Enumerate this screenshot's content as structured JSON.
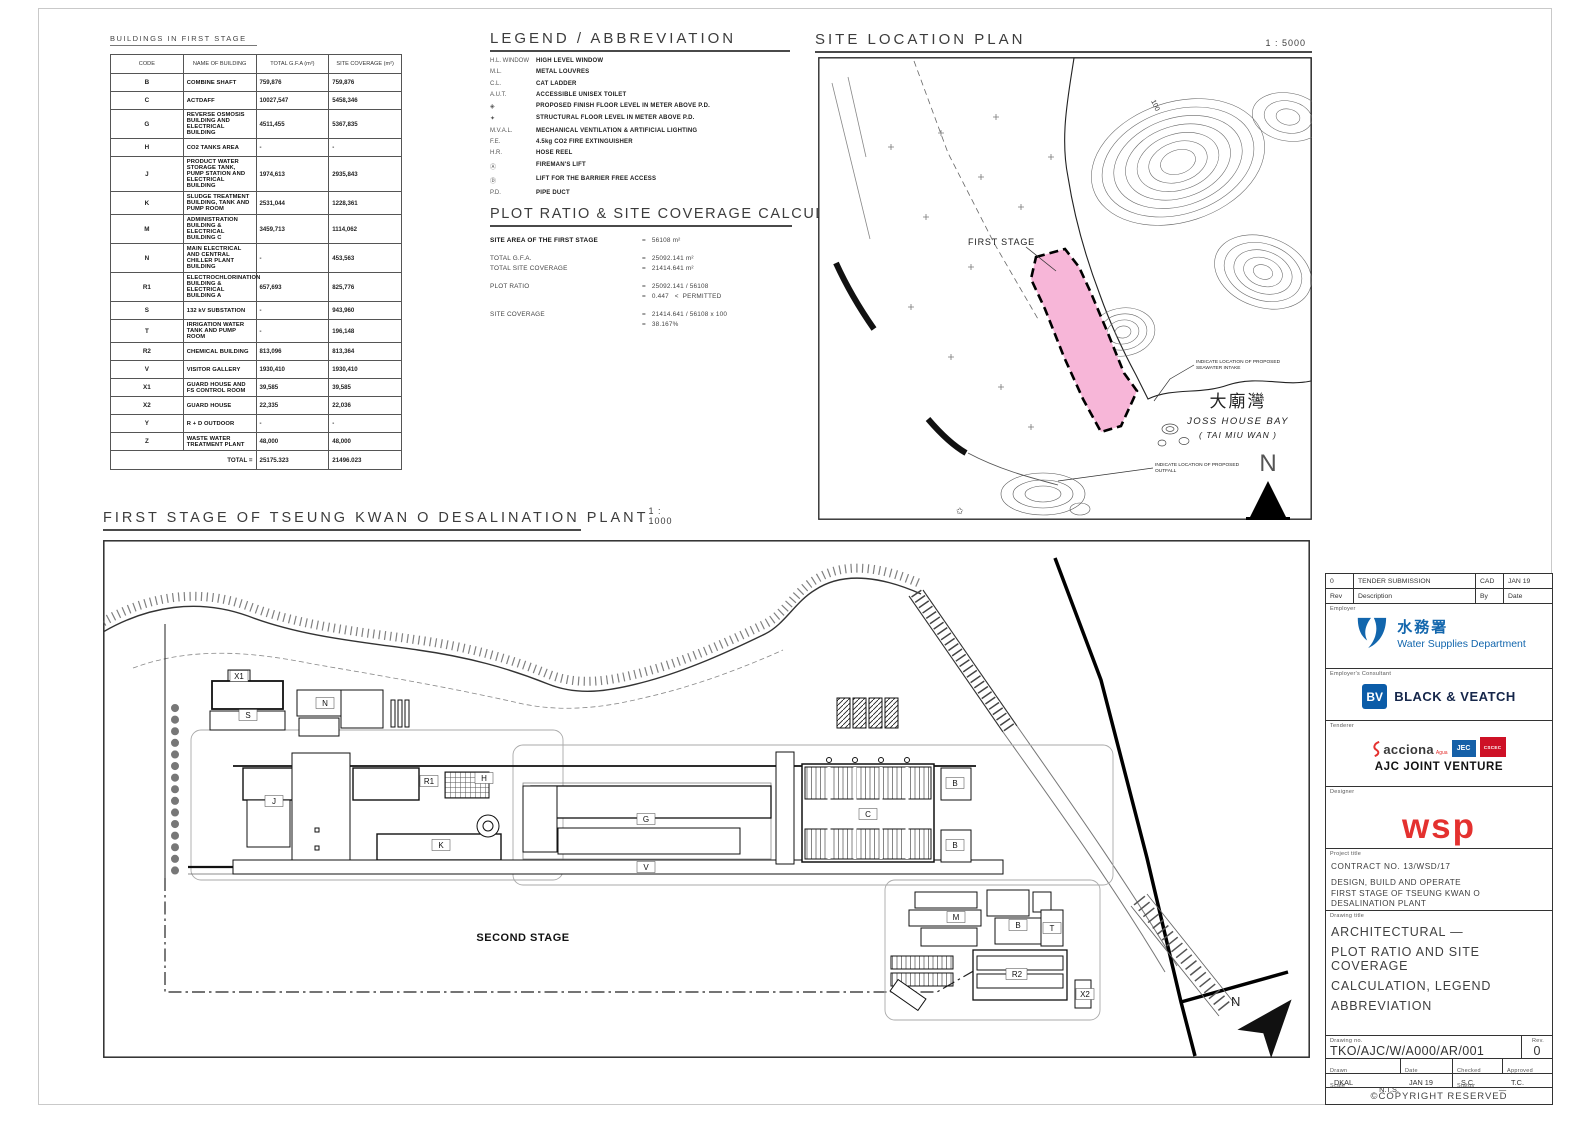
{
  "colors": {
    "site_pink": "#F7B6D8",
    "wsd_blue": "#1266AD",
    "bv_blue": "#0B5CA8",
    "wsp_red": "#E4312F",
    "jec_blue": "#1560A8",
    "cscec_red": "#CE1126"
  },
  "buildings_table": {
    "title": "BUILDINGS IN FIRST STAGE",
    "headers": [
      "CODE",
      "NAME OF BUILDING",
      "TOTAL G.F.A (m²)",
      "SITE COVERAGE (m²)"
    ],
    "rows": [
      {
        "code": "B",
        "name": "COMBINE SHAFT",
        "gfa": "759,876",
        "cov": "759,876"
      },
      {
        "code": "C",
        "name": "ACTDAFF",
        "gfa": "10027,547",
        "cov": "5458,346"
      },
      {
        "code": "G",
        "name": "REVERSE OSMOSIS BUILDING AND ELECTRICAL BUILDING",
        "gfa": "4511,455",
        "cov": "5367,835"
      },
      {
        "code": "H",
        "name": "CO2 TANKS AREA",
        "gfa": "-",
        "cov": "-"
      },
      {
        "code": "J",
        "name": "PRODUCT WATER STORAGE TANK, PUMP STATION AND ELECTRICAL BUILDING",
        "gfa": "1974,613",
        "cov": "2935,843"
      },
      {
        "code": "K",
        "name": "SLUDGE TREATMENT BUILDING, TANK AND PUMP ROOM",
        "gfa": "2531,044",
        "cov": "1228,361"
      },
      {
        "code": "M",
        "name": "ADMINISTRATION BUILDING & ELECTRICAL BUILDING C",
        "gfa": "3459,713",
        "cov": "1114,062"
      },
      {
        "code": "N",
        "name": "MAIN ELECTRICAL AND CENTRAL CHILLER PLANT BUILDING",
        "gfa": "-",
        "cov": "453,563"
      },
      {
        "code": "R1",
        "name": "ELECTROCHLORINATION BUILDING & ELECTRICAL BUILDING A",
        "gfa": "657,693",
        "cov": "825,776"
      },
      {
        "code": "S",
        "name": "132 kV SUBSTATION",
        "gfa": "-",
        "cov": "943,960"
      },
      {
        "code": "T",
        "name": "IRRIGATION WATER TANK AND PUMP ROOM",
        "gfa": "-",
        "cov": "196,148"
      },
      {
        "code": "R2",
        "name": "CHEMICAL BUILDING",
        "gfa": "813,096",
        "cov": "813,364"
      },
      {
        "code": "V",
        "name": "VISITOR GALLERY",
        "gfa": "1930,410",
        "cov": "1930,410"
      },
      {
        "code": "X1",
        "name": "GUARD HOUSE AND FS CONTROL ROOM",
        "gfa": "39,585",
        "cov": "39,585"
      },
      {
        "code": "X2",
        "name": "GUARD HOUSE",
        "gfa": "22,335",
        "cov": "22,036"
      },
      {
        "code": "Y",
        "name": "R + D OUTDOOR",
        "gfa": "-",
        "cov": "-"
      },
      {
        "code": "Z",
        "name": "WASTE WATER TREATMENT PLANT",
        "gfa": "48,000",
        "cov": "48,000"
      }
    ],
    "total_label": "TOTAL =",
    "total_gfa": "25175.323",
    "total_cov": "21496.023"
  },
  "legend": {
    "title": "LEGEND / ABBREVIATION",
    "items": [
      {
        "abbr": "H.L. WINDOW",
        "desc": "HIGH LEVEL WINDOW"
      },
      {
        "abbr": "M.L.",
        "desc": "METAL LOUVRES"
      },
      {
        "abbr": "C.L.",
        "desc": "CAT LADDER"
      },
      {
        "abbr": "A.U.T.",
        "desc": "ACCESSIBLE UNISEX TOILET"
      },
      {
        "abbr": "◈",
        "desc": "PROPOSED FINISH FLOOR LEVEL IN METER ABOVE P.D."
      },
      {
        "abbr": "✦",
        "desc": "STRUCTURAL FLOOR LEVEL IN METER ABOVE P.D."
      },
      {
        "abbr": "M.V.A.L.",
        "desc": "MECHANICAL VENTILATION & ARTIFICIAL LIGHTING"
      },
      {
        "abbr": "F.E.",
        "desc": "4.5kg CO2 FIRE EXTINGUISHER"
      },
      {
        "abbr": "H.R.",
        "desc": "HOSE REEL"
      },
      {
        "abbr": "Ⓐ",
        "desc": "FIREMAN'S LIFT"
      },
      {
        "abbr": "Ⓓ",
        "desc": "LIFT FOR THE BARRIER FREE ACCESS"
      },
      {
        "abbr": "P.D.",
        "desc": "PIPE DUCT"
      }
    ]
  },
  "calculation": {
    "title": "PLOT RATIO & SITE COVERAGE CALCULATION:",
    "rows": [
      {
        "label": "SITE AREA OF THE FIRST STAGE",
        "value": "=   56108 m²"
      },
      {
        "label": "TOTAL G.F.A.",
        "value": "=   25092.141 m²"
      },
      {
        "label": "TOTAL SITE COVERAGE",
        "value": "=   21414.641 m²"
      },
      {
        "label": "PLOT RATIO",
        "value": "=   25092.141 / 56108"
      },
      {
        "label": "",
        "value": "=   0.447   <  PERMITTED"
      },
      {
        "label": "SITE COVERAGE",
        "value": "=   21414.641 / 56108 x 100"
      },
      {
        "label": "",
        "value": "=   38.167%"
      }
    ]
  },
  "site_location_plan": {
    "title": "SITE LOCATION PLAN",
    "scale": "1 : 5000",
    "first_stage": "FIRST STAGE",
    "contour_label": "100",
    "bay_cn": "大廟灣",
    "bay_en": "JOSS HOUSE BAY",
    "bay_sub": "( TAI MIU WAN )",
    "north": "N",
    "note_intake_1": "INDICATE LOCATION OF PROPOSED",
    "note_intake_2": "SEAWATER INTAKE",
    "note_outfall_1": "INDICATE LOCATION OF PROPOSED",
    "note_outfall_2": "OUTFALL"
  },
  "main_plan": {
    "title": "FIRST STAGE OF TSEUNG KWAN O DESALINATION PLANT",
    "scale": "1 : 1000",
    "second_stage": "SECOND STAGE",
    "north": "N",
    "labels": [
      "X1",
      "S",
      "N",
      "J",
      "R1",
      "H",
      "K",
      "G",
      "V",
      "C",
      "B",
      "B",
      "M",
      "B",
      "T",
      "R2",
      "X2"
    ]
  },
  "title_block": {
    "rev_entry": {
      "rev": "0",
      "description": "TENDER SUBMISSION",
      "by": "CAD",
      "date": "JAN 19"
    },
    "rev_cols": {
      "rev": "Rev",
      "description": "Description",
      "by": "By",
      "date": "Date"
    },
    "employer": {
      "label": "Employer",
      "name_cn": "水務署",
      "name_en": "Water Supplies Department"
    },
    "consultant": {
      "label": "Employer's Consultant",
      "logo": "BV",
      "name": "BLACK & VEATCH"
    },
    "tenderer": {
      "label": "Tenderer",
      "logo1": "acciona",
      "logo1_sub": "Agua",
      "logo2": "JEC",
      "logo3": "CSCEC",
      "name": "AJC JOINT VENTURE"
    },
    "designer": {
      "label": "Designer",
      "name": "wsp"
    },
    "project": {
      "label": "Project title",
      "contract": "CONTRACT NO. 13/WSD/17",
      "line1": "DESIGN, BUILD AND OPERATE",
      "line2": "FIRST STAGE OF TSEUNG KWAN O",
      "line3": "DESALINATION PLANT"
    },
    "drawing": {
      "label": "Drawing title",
      "line1": "ARCHITECTURAL —",
      "line2": "PLOT RATIO AND SITE COVERAGE",
      "line3": "CALCULATION, LEGEND",
      "line4": "ABBREVIATION"
    },
    "drawing_no": {
      "label": "Drawing no.",
      "value": "TKO/AJC/W/A000/AR/001",
      "rev_label": "Rev.",
      "rev": "0"
    },
    "meta": {
      "drawn_label": "Drawn",
      "drawn": "DKAL",
      "date_label": "Date",
      "date": "JAN 19",
      "checked_label": "Checked",
      "checked": "S.C.",
      "approved_label": "Approved",
      "approved": "T.C.",
      "scale_label": "Scale",
      "scale": "N.T.S.",
      "status_label": "Status",
      "status": "—"
    },
    "copyright": "©COPYRIGHT RESERVED"
  }
}
